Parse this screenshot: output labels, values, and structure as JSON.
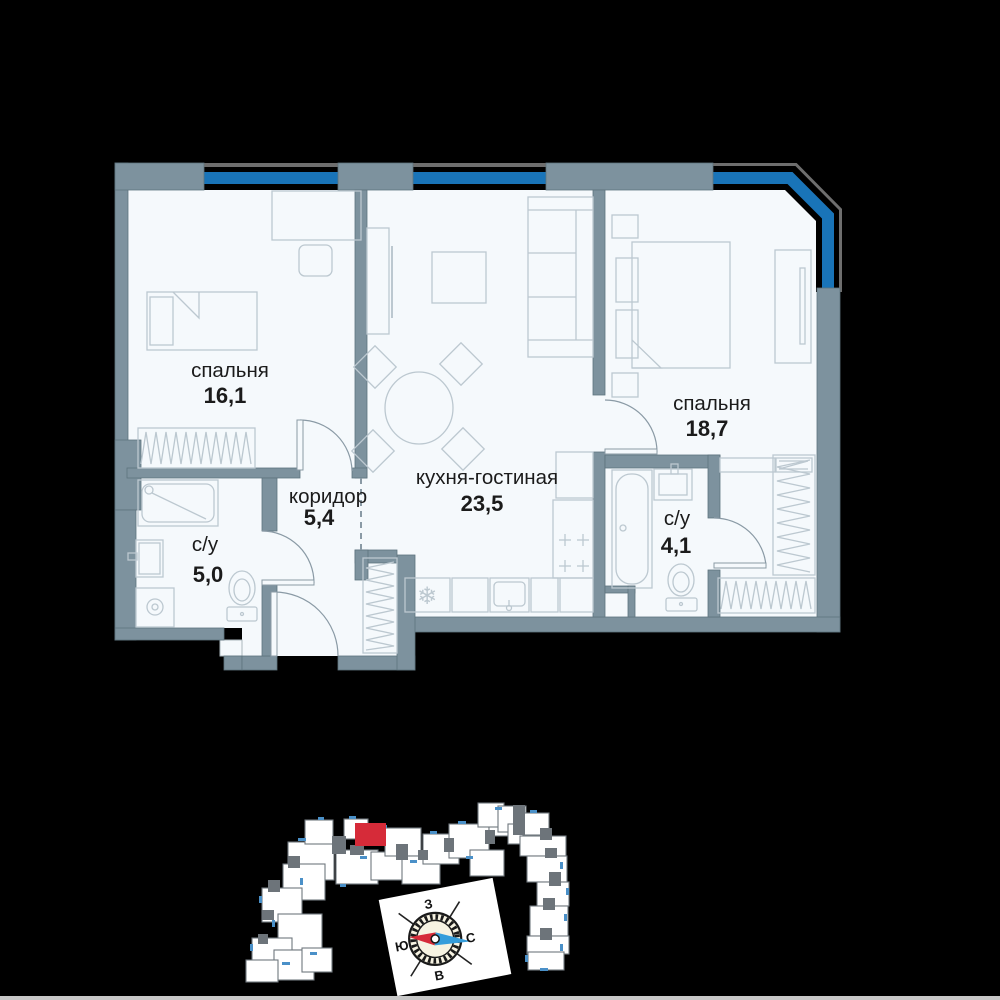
{
  "floorplan": {
    "rooms": [
      {
        "id": "bedroom-1",
        "name": "спальня",
        "area": "16,1"
      },
      {
        "id": "kitchen-living",
        "name": "кухня-гостиная",
        "area": "23,5"
      },
      {
        "id": "bedroom-2",
        "name": "спальня",
        "area": "18,7"
      },
      {
        "id": "corridor",
        "name": "коридор",
        "area": "5,4"
      },
      {
        "id": "bathroom-1",
        "name": "с/у",
        "area": "5,0"
      },
      {
        "id": "bathroom-2",
        "name": "с/у",
        "area": "4,1"
      }
    ],
    "colors": {
      "wall": "#7d929e",
      "walledge": "#5e737e",
      "blue": "#1974b8",
      "frame": "#6e6e6e",
      "floor": "#f5f9fc",
      "furn": "#bcc8d0",
      "door": "#8a9aa5",
      "textc": "#1b1b1b"
    }
  },
  "siteplan": {
    "colors": {
      "block": "#ffffff",
      "blockedge": "#70787e",
      "connector": "#6d747a",
      "tick": "#4a90c8",
      "highlight": "#d62b39"
    },
    "red_unit": [
      355,
      823,
      31,
      23
    ],
    "blocks": [
      [
        288,
        842,
        46,
        38
      ],
      [
        305,
        820,
        28,
        24
      ],
      [
        336,
        850,
        42,
        34
      ],
      [
        344,
        819,
        24,
        20
      ],
      [
        371,
        852,
        32,
        28
      ],
      [
        385,
        828,
        36,
        28
      ],
      [
        402,
        856,
        38,
        28
      ],
      [
        423,
        834,
        36,
        30
      ],
      [
        449,
        824,
        40,
        34
      ],
      [
        470,
        850,
        34,
        26
      ],
      [
        489,
        810,
        32,
        26
      ],
      [
        478,
        803,
        26,
        24
      ],
      [
        498,
        806,
        28,
        26
      ],
      [
        508,
        824,
        24,
        20
      ],
      [
        523,
        813,
        26,
        22
      ],
      [
        520,
        836,
        46,
        20
      ],
      [
        527,
        856,
        40,
        26
      ],
      [
        537,
        882,
        32,
        24
      ],
      [
        530,
        906,
        38,
        30
      ],
      [
        527,
        936,
        42,
        18
      ],
      [
        528,
        952,
        36,
        18
      ],
      [
        283,
        864,
        42,
        36
      ],
      [
        262,
        888,
        40,
        34
      ],
      [
        278,
        914,
        44,
        36
      ],
      [
        252,
        938,
        40,
        32
      ],
      [
        274,
        950,
        40,
        30
      ],
      [
        246,
        960,
        32,
        22
      ],
      [
        302,
        948,
        30,
        24
      ]
    ],
    "connectors": [
      [
        332,
        836,
        14,
        18
      ],
      [
        396,
        844,
        12,
        16
      ],
      [
        444,
        838,
        10,
        14
      ],
      [
        485,
        830,
        10,
        14
      ],
      [
        513,
        805,
        12,
        30
      ],
      [
        540,
        828,
        12,
        12
      ],
      [
        545,
        848,
        12,
        10
      ],
      [
        549,
        872,
        12,
        14
      ],
      [
        543,
        898,
        12,
        12
      ],
      [
        540,
        928,
        12,
        12
      ],
      [
        288,
        856,
        12,
        12
      ],
      [
        268,
        880,
        12,
        12
      ],
      [
        262,
        910,
        12,
        10
      ],
      [
        258,
        934,
        10,
        10
      ],
      [
        350,
        845,
        14,
        10
      ],
      [
        418,
        850,
        10,
        10
      ]
    ],
    "ticks": [
      [
        298,
        838,
        8,
        3
      ],
      [
        318,
        817,
        6,
        3
      ],
      [
        349,
        816,
        7,
        3
      ],
      [
        380,
        825,
        7,
        3
      ],
      [
        430,
        831,
        7,
        3
      ],
      [
        458,
        821,
        8,
        3
      ],
      [
        495,
        807,
        7,
        3
      ],
      [
        530,
        810,
        7,
        3
      ],
      [
        466,
        856,
        7,
        3
      ],
      [
        410,
        860,
        7,
        3
      ],
      [
        360,
        856,
        7,
        3
      ],
      [
        300,
        878,
        3,
        7
      ],
      [
        259,
        896,
        3,
        7
      ],
      [
        250,
        944,
        3,
        7
      ],
      [
        282,
        962,
        8,
        3
      ],
      [
        560,
        862,
        3,
        7
      ],
      [
        566,
        888,
        3,
        7
      ],
      [
        564,
        914,
        3,
        7
      ],
      [
        560,
        944,
        3,
        7
      ],
      [
        540,
        968,
        8,
        3
      ],
      [
        310,
        952,
        7,
        3
      ],
      [
        272,
        920,
        3,
        7
      ],
      [
        340,
        884,
        6,
        3
      ],
      [
        525,
        955,
        3,
        7
      ]
    ]
  },
  "compass": {
    "labels": {
      "top": "З",
      "left": "Ю",
      "right": "С",
      "bottom": "В"
    },
    "colors": {
      "card": "#ffffff",
      "face": "#f7f3e2",
      "south": "#d62b39",
      "north": "#359ddb"
    }
  }
}
